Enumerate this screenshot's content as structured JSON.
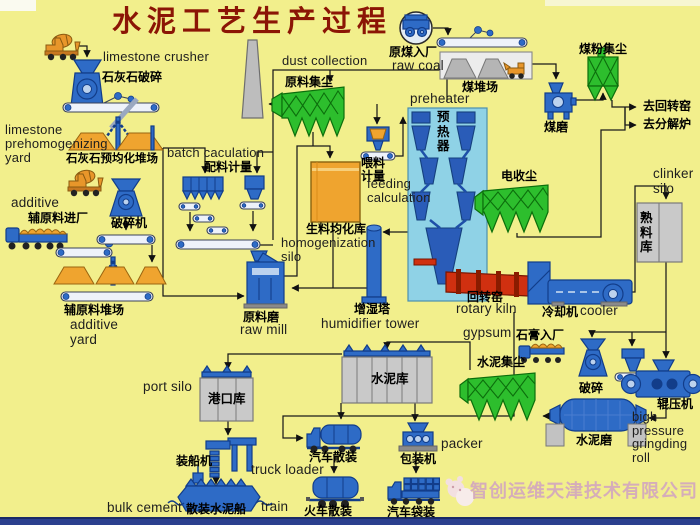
{
  "title": "水泥工艺生产过程",
  "watermark": {
    "company": "智创运维天津技术有限公司"
  },
  "colors": {
    "background": "#f2ef8c",
    "title_red": "#8b1505",
    "machine_blue": "#2e6bc6",
    "collector_green": "#2dbe2d",
    "kiln_red": "#d03010",
    "silo_gray": "#c9c9c9",
    "pile_orange": "#efa42f",
    "watermark_pink": "#d3a9bd",
    "bottom_strip_blue": "#2b3f8e"
  },
  "labels": {
    "limestone_crusher_en": "limestone crusher",
    "limestone_crusher_zh": "石灰石破碎",
    "limestone_yard_en": "limestone\nprehomogenizing\nyard",
    "limestone_yard_zh": "石灰石预均化堆场",
    "batch_calc_en": "batch caculation",
    "batch_calc_zh": "配料计量",
    "additive_en": "additive",
    "additive_in_zh": "辅原料进厂",
    "crusher_machine_zh": "破碎机",
    "additive_yard_zh": "辅原料堆场",
    "additive_yard_en": "additive\nyard",
    "dust_collection_en": "dust collection",
    "raw_dust_zh": "原料集尘",
    "raw_coal_zh": "原煤入厂",
    "raw_coal_en": "raw coal",
    "coal_yard_zh": "煤堆场",
    "coal_dust_zh": "煤粉集尘",
    "coal_mill_zh": "煤磨",
    "to_rotary_kiln_zh": "去回转窑",
    "to_calciner_zh": "去分解炉",
    "preheater_en": "preheater",
    "preheater_zh": "预热器",
    "feeding_zh": "喂料\n计量",
    "feeding_en": "feeding\ncalculation",
    "homogenization_zh": "生料均化库",
    "homogenization_en": "homogenization\nsilo",
    "esp_zh": "电收尘",
    "clinker_silo_en": "clinker\nsilo",
    "clinker_silo_zh": "熟料库",
    "raw_mill_zh": "原料磨",
    "raw_mill_en": "raw mill",
    "humidifier_zh": "增湿塔",
    "humidifier_en": "humidifier tower",
    "rotary_kiln_zh": "回转窑",
    "rotary_kiln_en": "rotary kiln",
    "cooler_zh": "冷却机",
    "cooler_en": "cooler",
    "gypsum_en": "gypsum",
    "gypsum_zh": "石膏入厂",
    "cement_dust_zh": "水泥集尘",
    "cement_crusher_zh": "破碎",
    "roller_press_zh": "辊压机",
    "roller_press_en": "bigh\npressure\ngringding\nroll",
    "cement_mill_zh": "水泥磨",
    "cement_silo_zh": "水泥库",
    "port_silo_en": "port silo",
    "port_silo_zh": "港口库",
    "ship_loader_zh": "装船机",
    "truck_loader_en": "truck loader",
    "bulk_cement_en": "bulk cement",
    "bulk_ship_zh": "散装水泥船",
    "train_en": "train",
    "truck_bulk_zh": "汽车散装",
    "train_bulk_zh": "火车散装",
    "packer_zh": "包装机",
    "packer_en": "packer",
    "truck_bag_zh": "汽车袋装"
  }
}
